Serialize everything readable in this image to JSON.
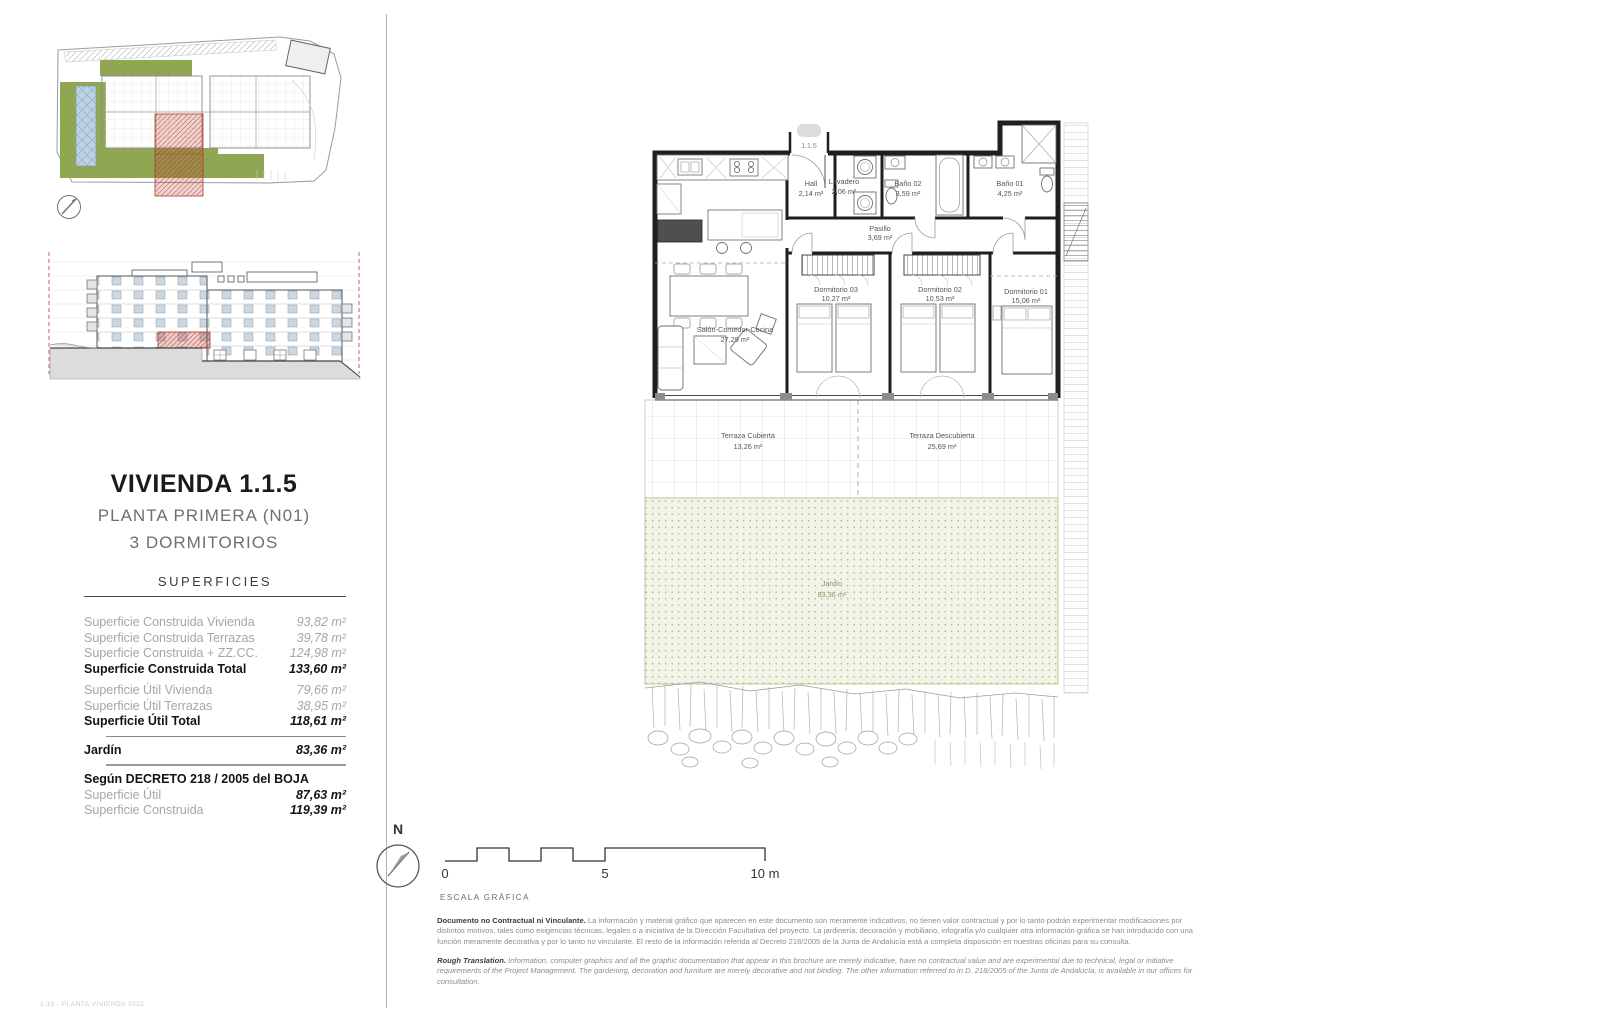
{
  "page": {
    "title": "VIVIENDA 1.1.5",
    "subtitle_floor": "PLANTA PRIMERA (N01)",
    "subtitle_bedrooms": "3 DORMITORIOS"
  },
  "superficies": {
    "title": "SUPERFICIES",
    "rows": [
      {
        "label": "Superficie Construida Vivienda",
        "value": "93,82 m²"
      },
      {
        "label": "Superficie Construida Terrazas",
        "value": "39,78 m²"
      },
      {
        "label": "Superficie Construida + ZZ.CC.",
        "value": "124,98 m²"
      },
      {
        "label": "Superficie Construida Total",
        "value": "133,60 m²"
      },
      {
        "label": "Superficie Útil Vivienda",
        "value": "79,66 m²"
      },
      {
        "label": "Superficie Útil Terrazas",
        "value": "38,95 m²"
      },
      {
        "label": "Superficie Útil Total",
        "value": "118,61 m²"
      },
      {
        "label": "Jardín",
        "value": "83,36 m²"
      },
      {
        "label": "Según DECRETO 218 / 2005 del BOJA",
        "value": ""
      },
      {
        "label": "Superficie Útil",
        "value": "87,63 m²"
      },
      {
        "label": "Superficie Construida",
        "value": "119,39 m²"
      }
    ]
  },
  "plan": {
    "unit_label": "1.1.5",
    "rooms": {
      "hall": {
        "name": "Hall",
        "area": "2,14 m²"
      },
      "lavadero": {
        "name": "Lavadero",
        "area": "2,06 m²"
      },
      "bano02": {
        "name": "Baño 02",
        "area": "3,59 m²"
      },
      "bano01": {
        "name": "Baño 01",
        "area": "4,25 m²"
      },
      "pasillo": {
        "name": "Pasillo",
        "area": "3,69 m²"
      },
      "salon": {
        "name": "Salón-Comedor-Cocina",
        "area": "27,29 m²"
      },
      "dormitorio03": {
        "name": "Dormitorio 03",
        "area": "10,27 m²"
      },
      "dormitorio02": {
        "name": "Dormitorio 02",
        "area": "10,53 m²"
      },
      "dormitorio01": {
        "name": "Dormitorio 01",
        "area": "15,06 m²"
      },
      "terraza_cubierta": {
        "name": "Terraza Cubierta",
        "area": "13,26 m²"
      },
      "terraza_descubierta": {
        "name": "Terraza Descubierta",
        "area": "25,69 m²"
      },
      "jardin": {
        "name": "Jardín",
        "area": "83,36 m²"
      }
    }
  },
  "scale_bar": {
    "north_label": "N",
    "tick_0": "0",
    "tick_5": "5",
    "tick_10": "10 m",
    "caption": "ESCALA GRÁFICA"
  },
  "disclaimer": {
    "es_lead": "Documento no Contractual ni Vinculante.",
    "es_body": " La información y material gráfico que aparecen en este documento son meramente indicativos, no tienen valor contractual y por lo tanto podrán experimentar modificaciones por distintos motivos, tales como exigencias técnicas, legales o a iniciativa de la Dirección Facultativa del proyecto. La jardinería, decoración y mobiliario, infografía y/o cualquier otra información gráfica se han introducido con una función meramente decorativa y por lo tanto no vinculante. El resto de la información referida al Decreto 218/2005 de la Junta de Andalucía está a completa disposición en nuestras oficinas para su consulta.",
    "en_lead": "Rough Translation.",
    "en_body": " Information, computer graphics and all the graphic documentation that appear in this brochure are merely indicative, have no contractual value and are experimental due to technical, legal or initiative requirements of the Project Management. The gardening, decoration and furniture are merely decorative and not binding. The other information referred to in D. 218/2005 of the Junta de Andalucía, is available in our offices for consultation."
  },
  "footer_code": "1.15 - PLANTA VIVIENDA 2022",
  "colors": {
    "green": "#8fa653",
    "red": "#c0392b",
    "pool_blue": "#bdd2e3"
  }
}
